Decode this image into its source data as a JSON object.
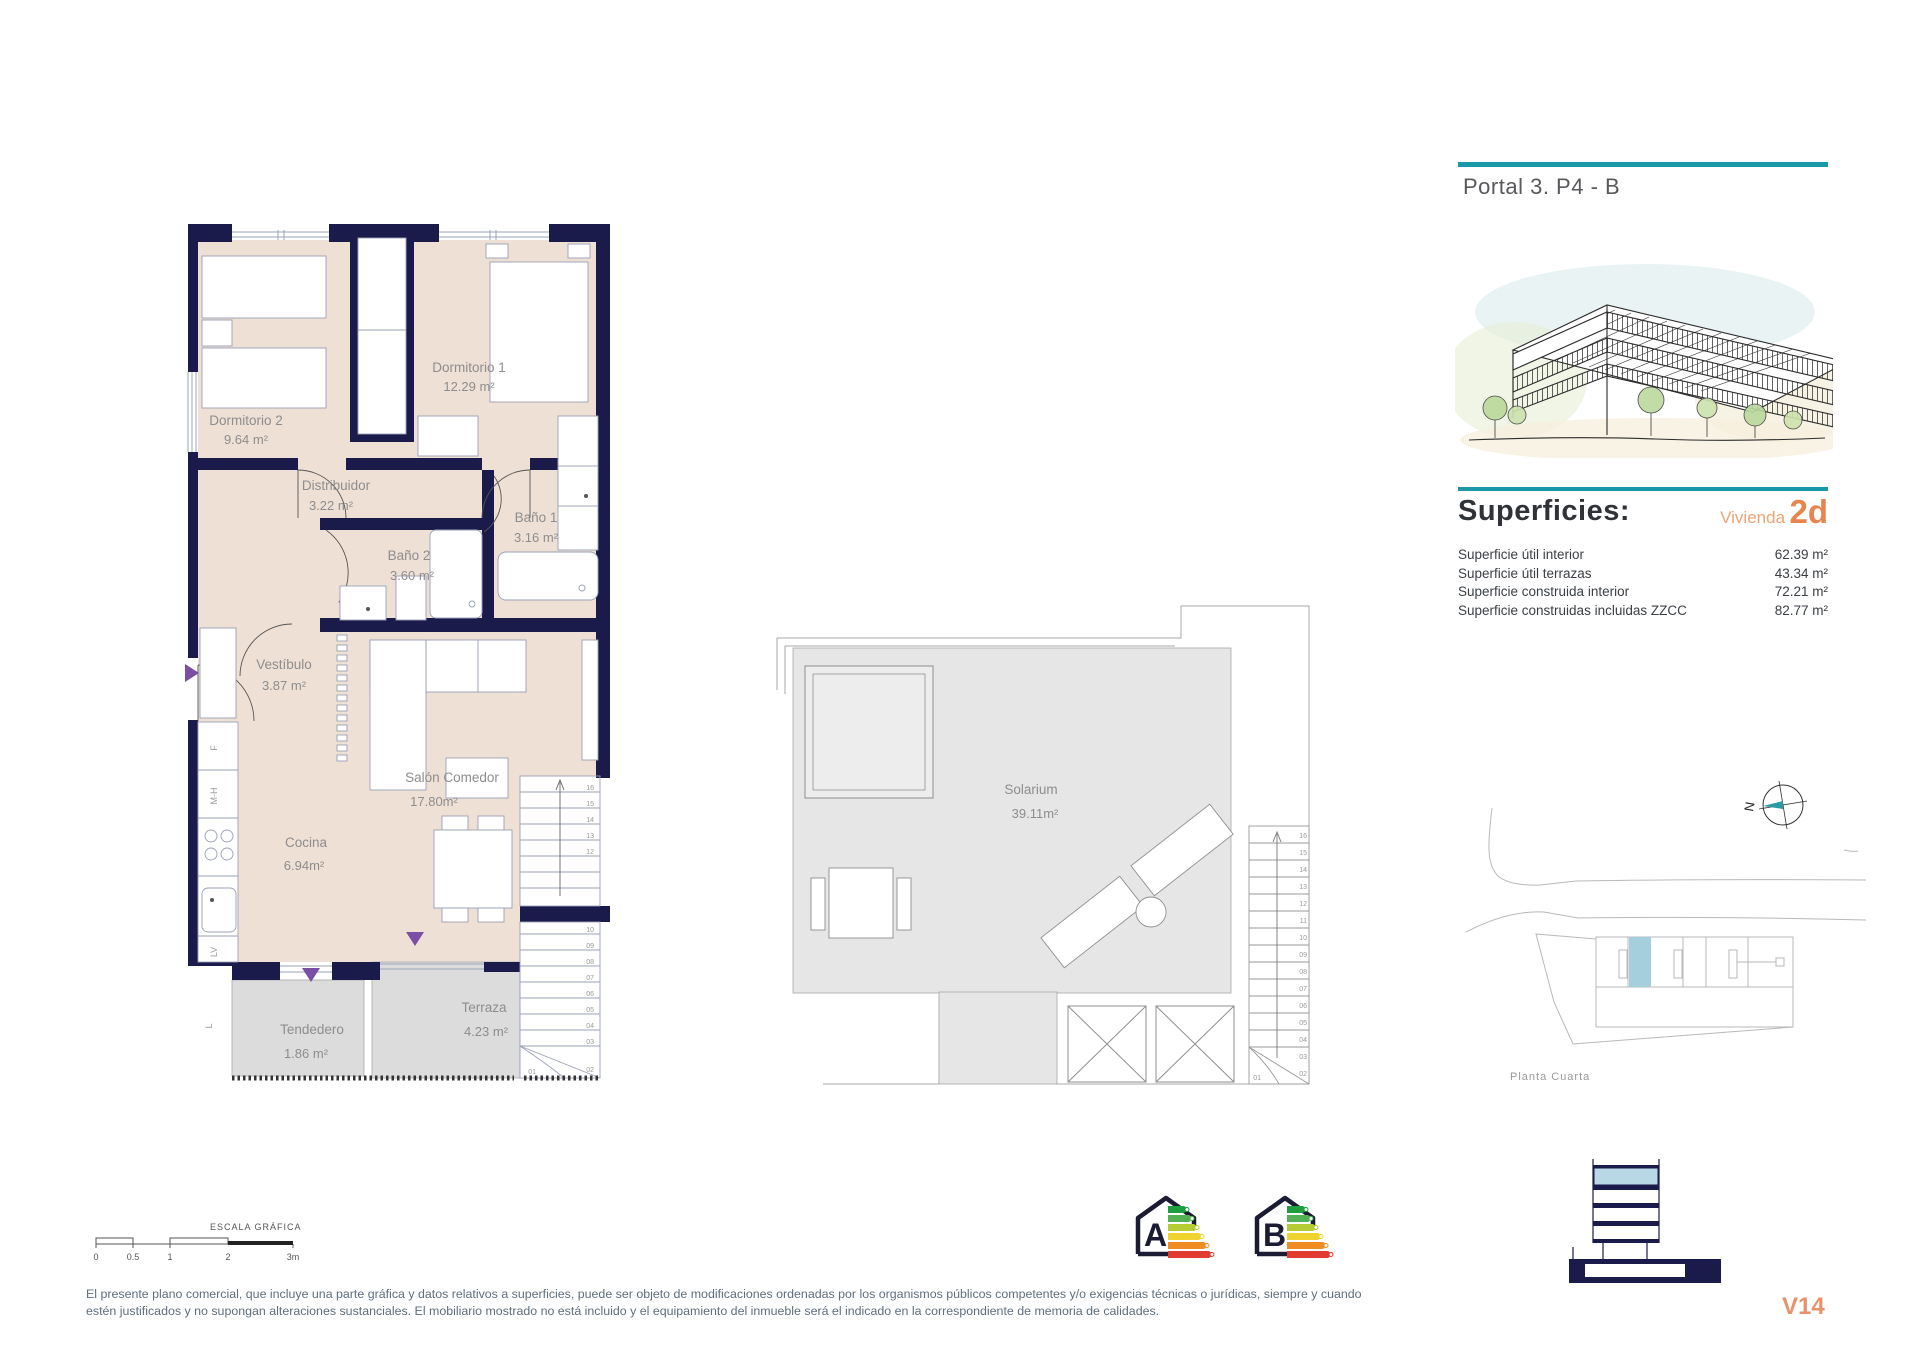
{
  "page": {
    "title": "Portal 3. P4 - B",
    "version": "V14"
  },
  "superficies": {
    "title": "Superficies:",
    "vivienda_label": "Vivienda",
    "vivienda_code": "2d",
    "rows": [
      {
        "label": "Superficie útil interior",
        "value": "62.39 m²"
      },
      {
        "label": "Superficie útil terrazas",
        "value": "43.34 m²"
      },
      {
        "label": "Superficie construida interior",
        "value": "72.21 m²"
      },
      {
        "label": "Superficie construidas incluidas ZZCC",
        "value": "82.77 m²"
      }
    ]
  },
  "floor_plan": {
    "rooms": [
      {
        "name": "Dormitorio 2",
        "area": "9.64 m²"
      },
      {
        "name": "Dormitorio 1",
        "area": "12.29 m²"
      },
      {
        "name": "Distribuidor",
        "area": "3.22 m²"
      },
      {
        "name": "Baño 1",
        "area": "3.16 m²"
      },
      {
        "name": "Baño 2",
        "area": "3.60 m²"
      },
      {
        "name": "Vestíbulo",
        "area": "3.87 m²"
      },
      {
        "name": "Salón Comedor",
        "area": "17.80m²"
      },
      {
        "name": "Cocina",
        "area": "6.94m²"
      },
      {
        "name": "Tendedero",
        "area": "1.86 m²"
      },
      {
        "name": "Terraza",
        "area": "4.23 m²"
      }
    ],
    "appliance_labels": [
      "F",
      "M-H",
      "LV",
      "L"
    ]
  },
  "solarium": {
    "name": "Solarium",
    "area": "39.11m²"
  },
  "stairs": [
    "01",
    "02",
    "03",
    "04",
    "05",
    "06",
    "07",
    "08",
    "09",
    "10",
    "11",
    "12",
    "13",
    "14",
    "15",
    "16"
  ],
  "site_plan": {
    "caption": "Planta Cuarta",
    "compass": "N"
  },
  "scale_bar": {
    "label": "ESCALA GRÁFICA",
    "ticks": [
      "0",
      "0.5",
      "1",
      "2",
      "3m"
    ]
  },
  "energy": {
    "labels": [
      "A",
      "B"
    ]
  },
  "disclaimer": {
    "line1": "El presente plano comercial, que incluye una parte gráfica y datos relativos a superficies, puede ser objeto de modificaciones ordenadas por los organismos públicos competentes y/o exigencias técnicas o jurídicas, siempre y cuando",
    "line2": "estén justificados y no supongan alteraciones sustanciales. El mobiliario mostrado no está incluido y el equipamiento del inmueble será el indicado en la correspondiente de memoria de calidades."
  },
  "colors": {
    "teal": "#1898A9",
    "orange": "#E8854F",
    "wall_navy": "#1B1B4B",
    "floor_beige": "#EFE0D6",
    "terrace_gray": "#DCDCDC",
    "highlight_blue": "#A5CFDC",
    "accent_purple": "#7B4FA6"
  }
}
